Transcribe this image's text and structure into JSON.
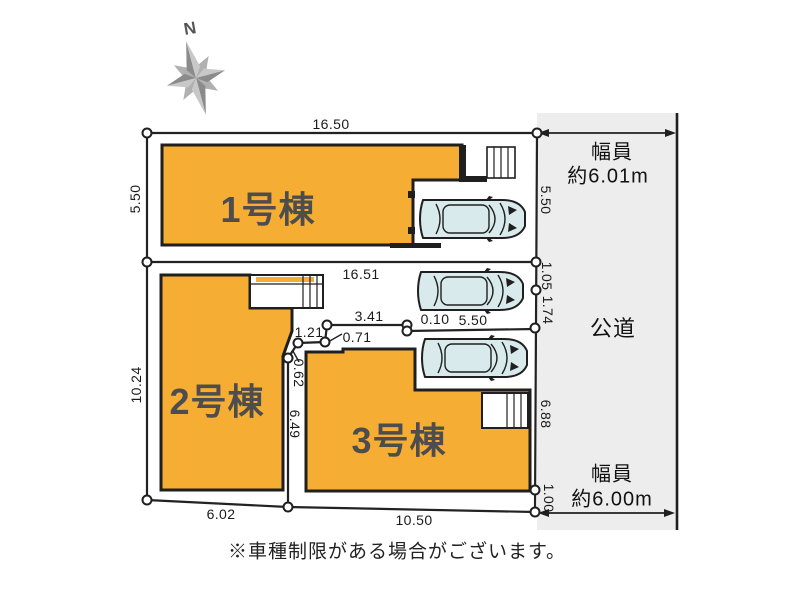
{
  "compass": {
    "north_label": "N"
  },
  "buildings": [
    {
      "name": "1号棟"
    },
    {
      "name": "2号棟"
    },
    {
      "name": "3号棟"
    }
  ],
  "dimensions": {
    "top_width": "16.50",
    "left_upper_height": "5.50",
    "left_lower_height": "10.24",
    "mid_width": "16.51",
    "bottom_left_width": "6.02",
    "bottom_right_width": "10.50",
    "right_upper_height": "5.50",
    "right_gap1": "1.05",
    "right_gap2": "1.74",
    "right_lower_height": "6.88",
    "right_gap3": "1.00",
    "inner_seg1": "1.21",
    "inner_seg2": "0.71",
    "inner_seg3": "3.41",
    "inner_seg4": "0.10",
    "inner_seg5": "5.50",
    "inner_diag": "0.62",
    "inner_vert": "6.49"
  },
  "road": {
    "name": "公道",
    "width_top_line1": "幅員",
    "width_top_line2": "約6.01m",
    "width_bottom_line1": "幅員",
    "width_bottom_line2": "約6.00m"
  },
  "note": "※車種制限がある場合がございます。",
  "colors": {
    "building_fill": "#F5AD33",
    "road_fill": "#EDEDEE",
    "car_fill": "#D8EAEC",
    "outline": "#1F1F1F"
  }
}
